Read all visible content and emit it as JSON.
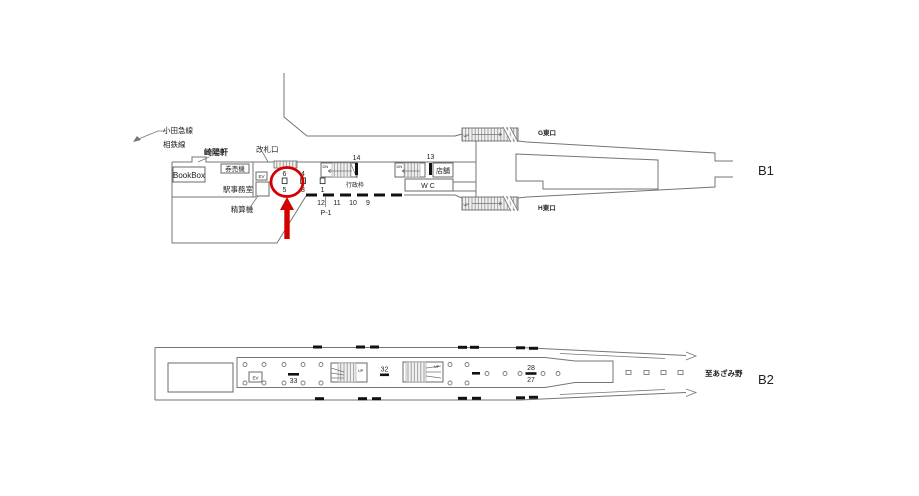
{
  "colors": {
    "accent_red": "#d40000",
    "outline_gray": "#757575",
    "ink": "#222222"
  },
  "b1": {
    "level_label": "B1",
    "odakyu_line_label": "小田急線",
    "sotetsu_line_label": "相鉄線",
    "kiyoken_label": "崎陽軒",
    "bookbox_label": "BookBox",
    "ticket_machine_label": "券売機",
    "ticket_gate_label": "改札口",
    "station_office_label": "駅事務室",
    "fare_adjustment_label": "精算機",
    "elevator_label": "EV",
    "admin_frame_label": "行政枠",
    "shop_label": "店舗",
    "wc_label": "WC",
    "g_east_exit_label": "G東口",
    "h_east_exit_label": "H東口",
    "up_label": "UP",
    "down_label": "DN",
    "ad_positions": {
      "no6": "6",
      "no5": "5",
      "no4": "4",
      "no3": "3",
      "no2": "2",
      "no1": "1",
      "no14": "14",
      "no13": "13",
      "no12": "12",
      "no11": "11",
      "no10": "10",
      "no9": "9",
      "p1": "P-1"
    }
  },
  "b2": {
    "level_label": "B2",
    "elevator_label": "EV",
    "up_label": "UP",
    "to_azamino_label": "至あざみ野",
    "ad_positions": {
      "no33": "33",
      "no32": "32",
      "no28": "28",
      "no27": "27"
    }
  }
}
